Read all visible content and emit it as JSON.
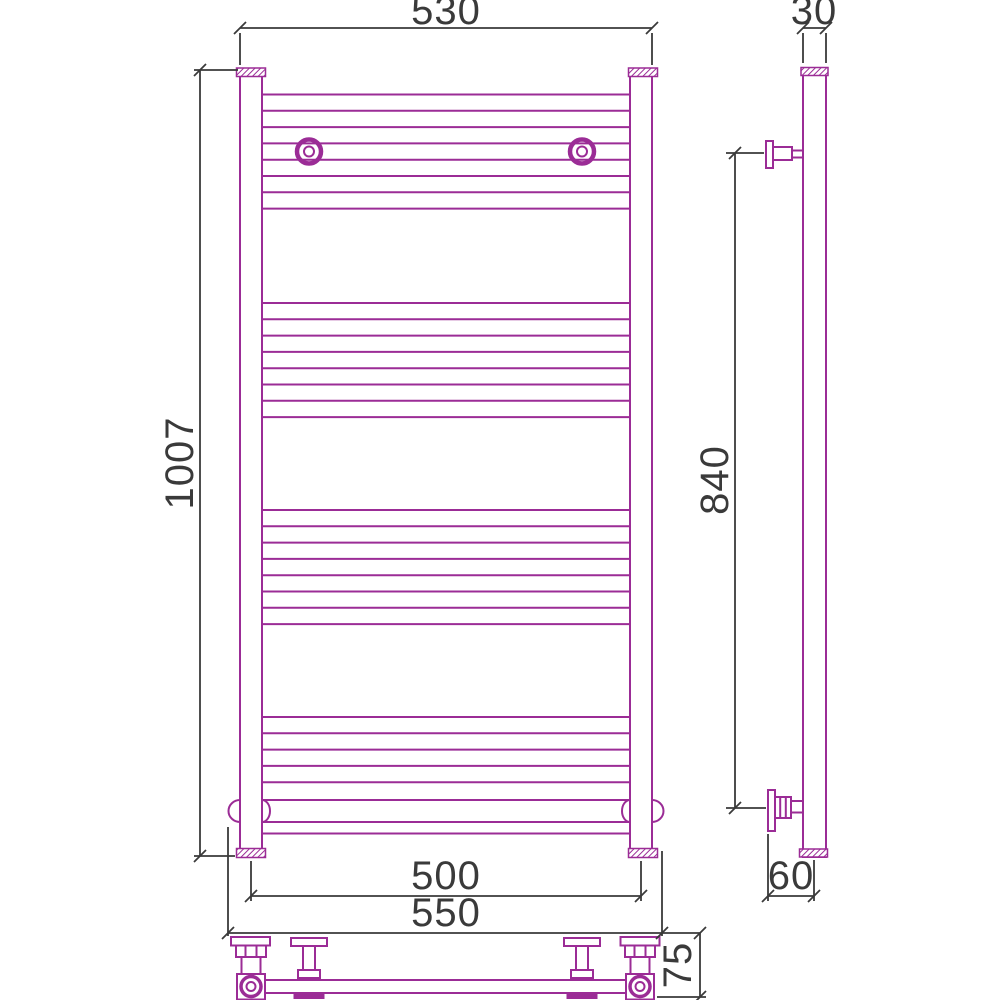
{
  "colors": {
    "part": "#9B2C96",
    "dimension": "#3A3A3A",
    "background": "#FFFFFF"
  },
  "front_view": {
    "dim_top_width": "530",
    "dim_height": "1007",
    "dim_axle_width": "500",
    "dim_overall_width": "550",
    "dim_connection_height": "75"
  },
  "side_view": {
    "dim_depth": "30",
    "dim_mount_span": "840",
    "dim_wall_distance": "60"
  }
}
